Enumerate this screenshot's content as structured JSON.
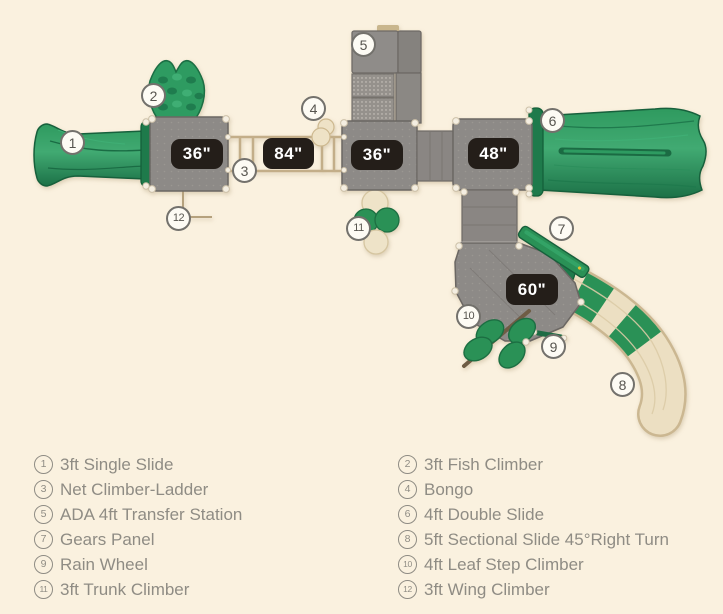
{
  "diagram": {
    "markers": [
      "1",
      "2",
      "3",
      "4",
      "5",
      "6",
      "7",
      "8",
      "9",
      "10",
      "11",
      "12"
    ],
    "height_labels": [
      "36\"",
      "84\"",
      "36\"",
      "48\"",
      "60\""
    ]
  },
  "legend": {
    "left": [
      {
        "number": "1",
        "label": "3ft Single Slide"
      },
      {
        "number": "3",
        "label": "Net Climber-Ladder"
      },
      {
        "number": "5",
        "label": "ADA 4ft Transfer Station"
      },
      {
        "number": "7",
        "label": "Gears Panel"
      },
      {
        "number": "9",
        "label": "Rain Wheel"
      },
      {
        "number": "11",
        "label": "3ft Trunk Climber"
      }
    ],
    "right": [
      {
        "number": "2",
        "label": "3ft Fish Climber"
      },
      {
        "number": "4",
        "label": "Bongo"
      },
      {
        "number": "6",
        "label": "4ft Double Slide"
      },
      {
        "number": "8",
        "label": "5ft Sectional Slide 45°Right Turn"
      },
      {
        "number": "10",
        "label": "4ft Leaf Step Climber"
      },
      {
        "number": "12",
        "label": "3ft Wing Climber"
      }
    ]
  },
  "colors": {
    "background": "#faf1df",
    "equipment_green": "#2e9b61",
    "equipment_green_dark": "#1e7a4b",
    "platform_gray": "#8d8a87",
    "slide_beige": "#ecdfc2",
    "ladder_tan": "#c3ae89",
    "height_label_bg": "#241e19",
    "height_label_text": "#ffffff",
    "legend_text": "#8f8c84"
  }
}
